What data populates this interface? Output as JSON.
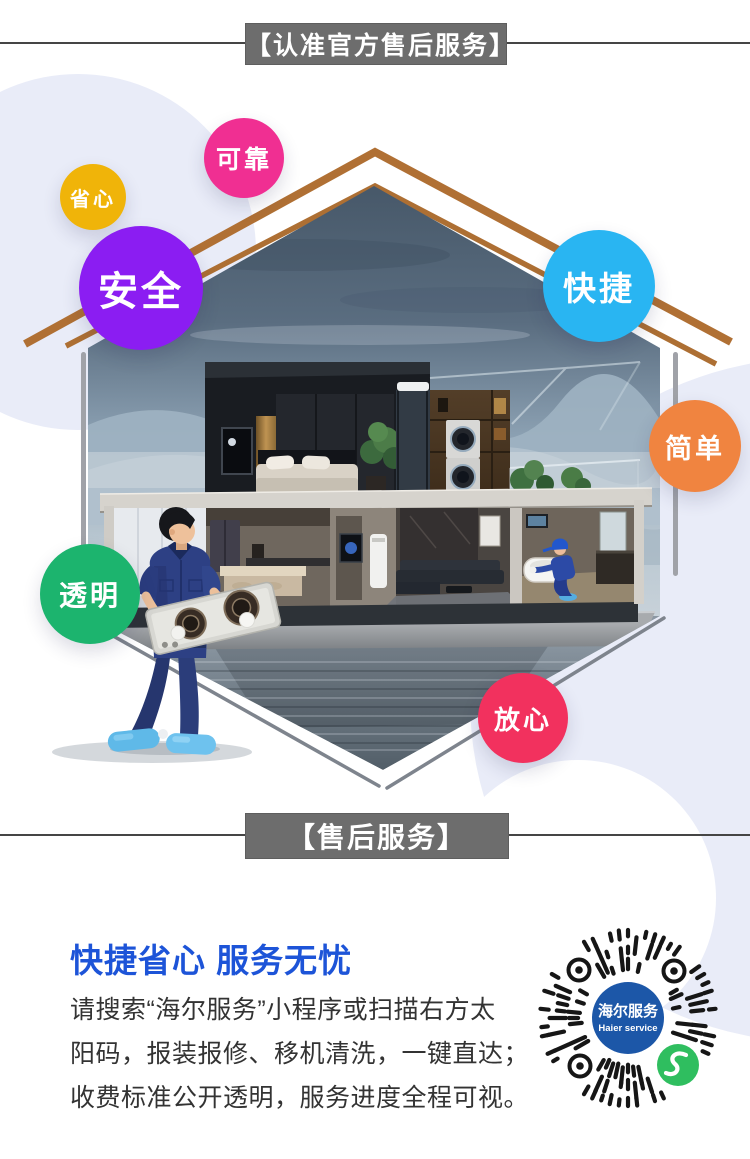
{
  "top_banner": {
    "label": "【认准官方售后服务】",
    "bg": "#6d6d6d",
    "text_color": "#ffffff"
  },
  "bottom_banner": {
    "label": "【售后服务】",
    "bg": "#6d6d6d",
    "text_color": "#ffffff"
  },
  "badges": [
    {
      "label": "省心",
      "color": "#f0b409"
    },
    {
      "label": "可靠",
      "color": "#f02f92"
    },
    {
      "label": "安全",
      "color": "#8b1df2"
    },
    {
      "label": "快捷",
      "color": "#29b5f2"
    },
    {
      "label": "简单",
      "color": "#f08440"
    },
    {
      "label": "透明",
      "color": "#1cb46e"
    },
    {
      "label": "放心",
      "color": "#f2315e"
    }
  ],
  "scene": {
    "roof_color": "#b07034",
    "background_blob_color": "#e9ecf8"
  },
  "info": {
    "heading": "快捷省心 服务无忧",
    "heading_color": "#1d54d8",
    "lines": [
      "请搜索“海尔服务”小程序或扫描右方太",
      "阳码，报装报修、移机清洗，一键直达；",
      "收费标准公开透明，服务进度全程可视。"
    ]
  },
  "suncode": {
    "center_line1": "海尔服务",
    "center_line2": "Haier service",
    "center_color": "#1c57a8",
    "wechat_green": "#2fbe5f"
  }
}
